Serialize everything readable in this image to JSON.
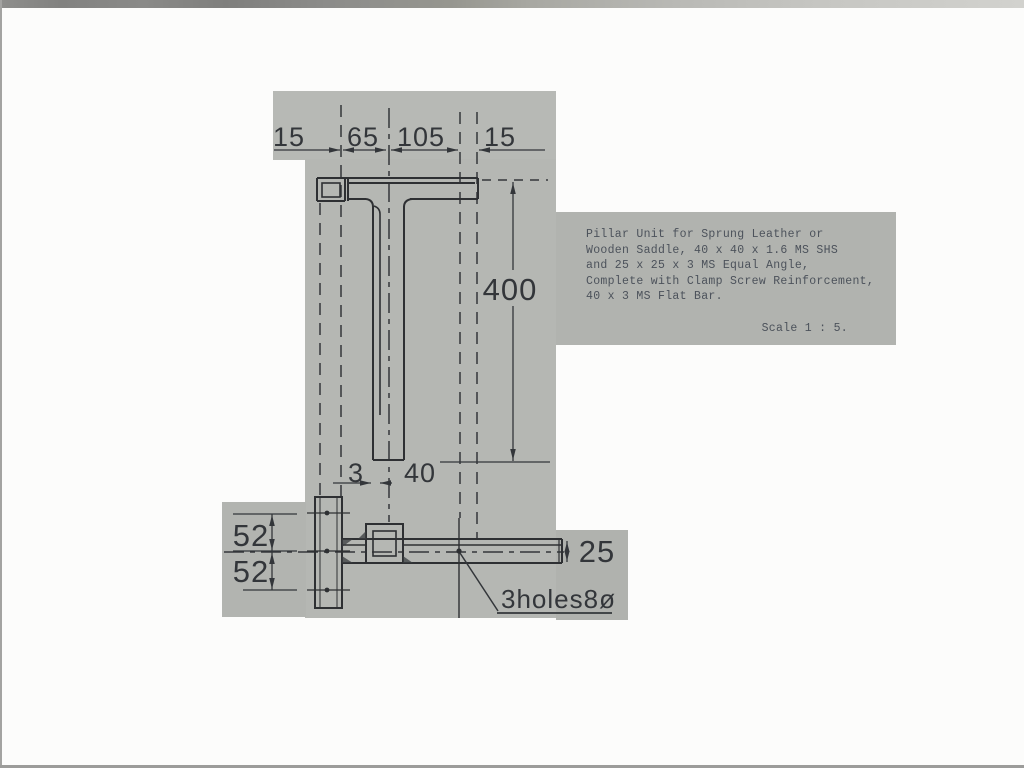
{
  "photo": {
    "paper_color": "#b5b7b3",
    "line_color": "#2e3033",
    "description": "Scanned engineering drawing of a pillar unit"
  },
  "note": {
    "lines": [
      "Pillar Unit for Sprung Leather or",
      "Wooden Saddle, 40 x 40 x 1.6 MS SHS",
      "and 25 x 25 x 3 MS Equal Angle,",
      "Complete with Clamp Screw Reinforcement,",
      "40 x 3 MS Flat Bar."
    ],
    "scale": "Scale 1 : 5."
  },
  "dimensions": {
    "top_left_margin": "15",
    "top_span_left": "65",
    "top_span_right": "105",
    "top_right_margin": "15",
    "pillar_height": "400",
    "wall_thickness": "3",
    "pillar_width": "40",
    "hole_spacing_upper": "52",
    "hole_spacing_lower": "52",
    "bar_height": "25",
    "holes_label": "3holes8ø"
  }
}
